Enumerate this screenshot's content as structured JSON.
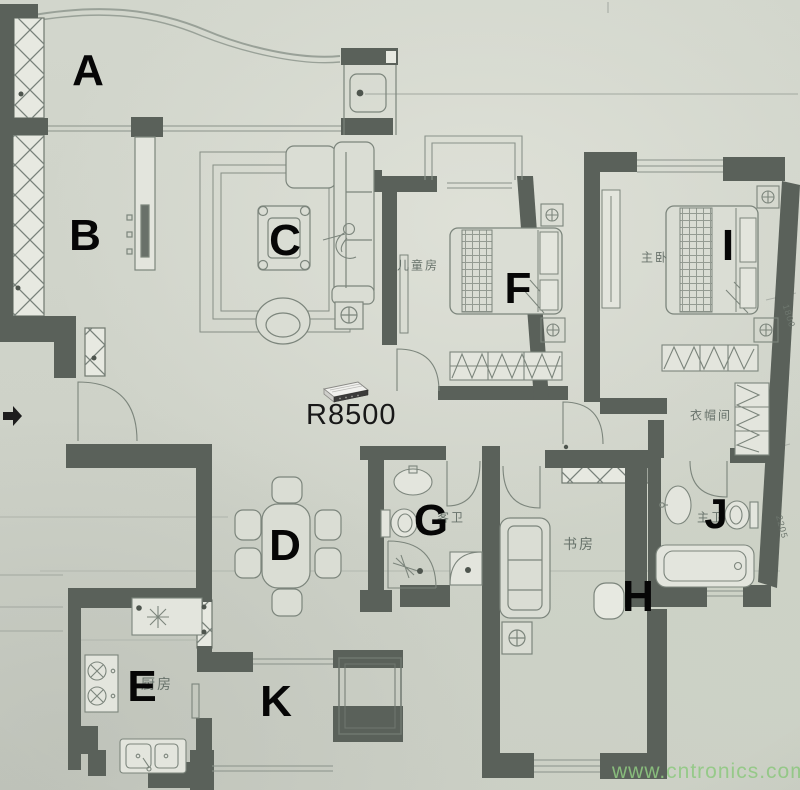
{
  "photo": {
    "paper_color": "#d2d6cc",
    "wall_color": "#5a615a",
    "furniture_line_color": "#7c857c",
    "letter_color": "#060606"
  },
  "markers": [
    {
      "id": "A",
      "label": "A",
      "x": 88,
      "y": 71,
      "size": 44
    },
    {
      "id": "B",
      "label": "B",
      "x": 85,
      "y": 236,
      "size": 44
    },
    {
      "id": "C",
      "label": "C",
      "x": 285,
      "y": 241,
      "size": 44
    },
    {
      "id": "D",
      "label": "D",
      "x": 285,
      "y": 546,
      "size": 44
    },
    {
      "id": "E",
      "label": "E",
      "x": 142,
      "y": 687,
      "size": 44
    },
    {
      "id": "F",
      "label": "F",
      "x": 518,
      "y": 289,
      "size": 44
    },
    {
      "id": "G",
      "label": "G",
      "x": 431,
      "y": 521,
      "size": 44
    },
    {
      "id": "H",
      "label": "H",
      "x": 638,
      "y": 597,
      "size": 44
    },
    {
      "id": "I",
      "label": "I",
      "x": 728,
      "y": 246,
      "size": 44
    },
    {
      "id": "J",
      "label": "J",
      "x": 716,
      "y": 514,
      "size": 42
    },
    {
      "id": "K",
      "label": "K",
      "x": 276,
      "y": 702,
      "size": 44
    }
  ],
  "room_labels": [
    {
      "id": "childrens-room",
      "text": "儿童房",
      "x": 418,
      "y": 265,
      "size": 12
    },
    {
      "id": "master-bedroom",
      "text": "主卧",
      "x": 655,
      "y": 257,
      "size": 12
    },
    {
      "id": "cloakroom",
      "text": "衣帽间",
      "x": 711,
      "y": 415,
      "size": 12
    },
    {
      "id": "study",
      "text": "书房",
      "x": 579,
      "y": 544,
      "size": 14
    },
    {
      "id": "guest-bath",
      "text": "客卫",
      "x": 451,
      "y": 517,
      "size": 12
    },
    {
      "id": "master-bath",
      "text": "主卫",
      "x": 711,
      "y": 517,
      "size": 12
    },
    {
      "id": "kitchen",
      "text": "厨房",
      "x": 157,
      "y": 684,
      "size": 14
    }
  ],
  "dimensions": [
    {
      "text": "1800",
      "x": 789,
      "y": 316,
      "rotate": 73
    },
    {
      "text": "2205",
      "x": 782,
      "y": 527,
      "rotate": 75
    }
  ],
  "router": {
    "model_label": "R8500"
  },
  "watermark": {
    "text": "www.cntronics.com",
    "color": "#8ec881"
  }
}
